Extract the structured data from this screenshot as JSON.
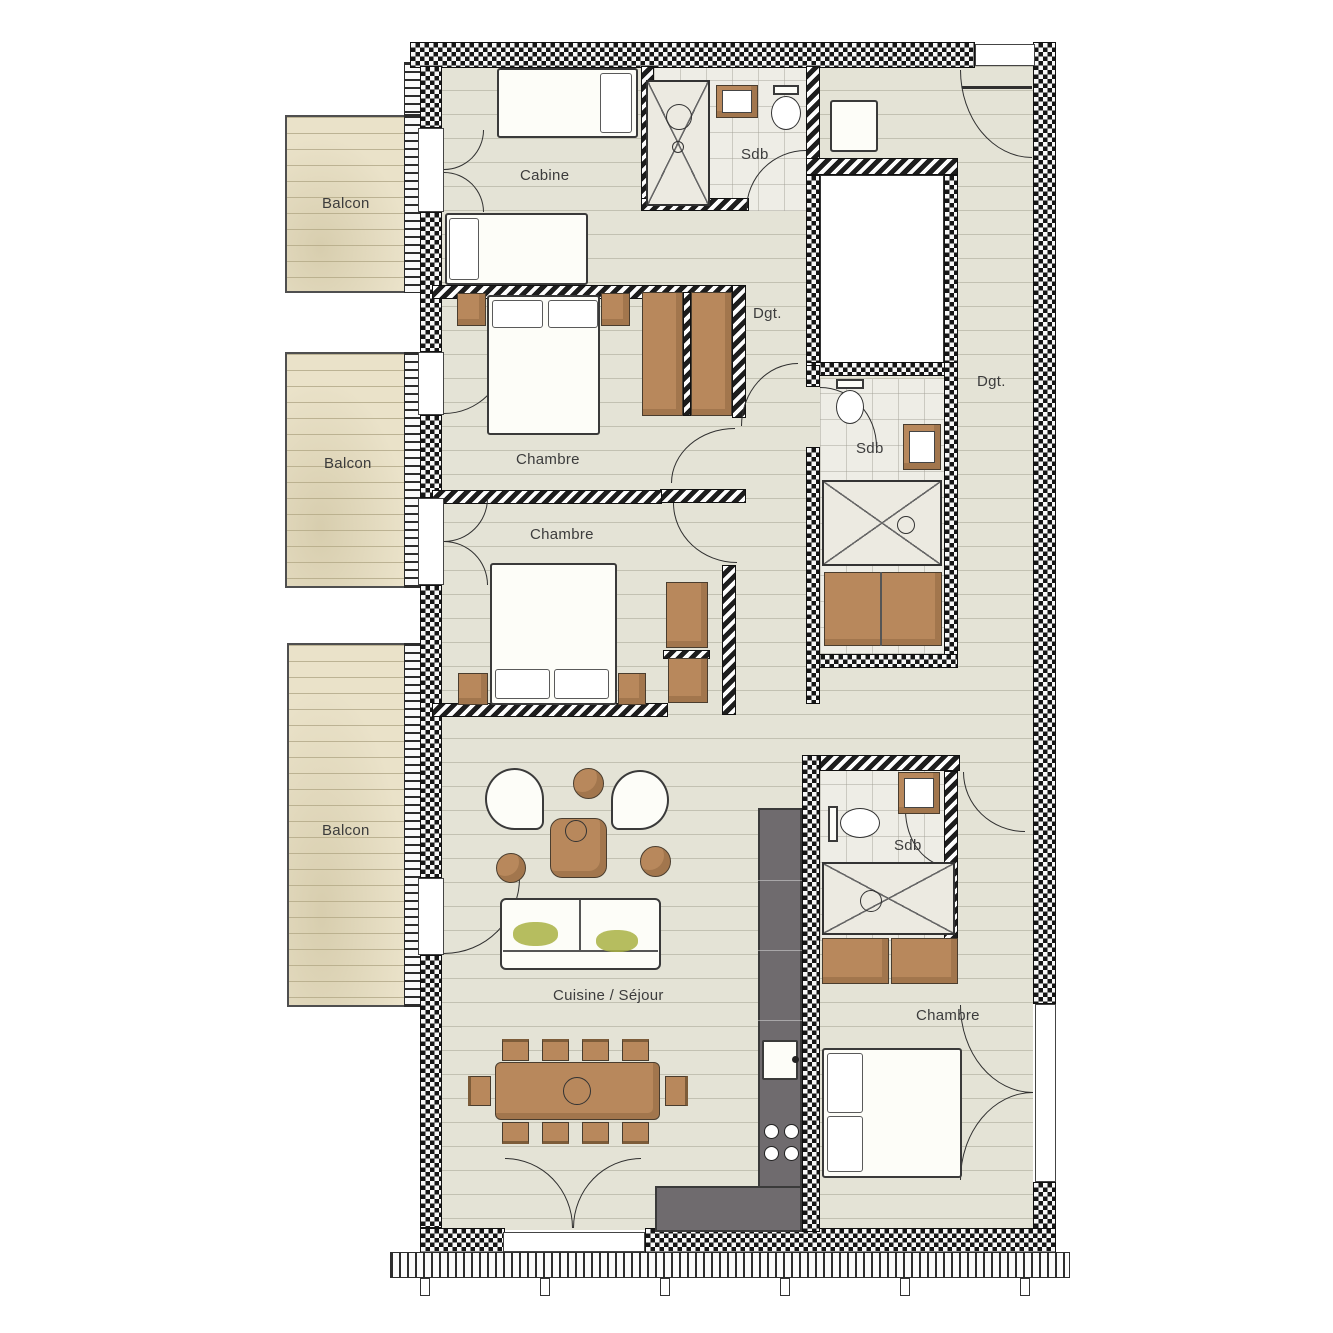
{
  "plan": {
    "rooms": {
      "balcon1": "Balcon",
      "balcon2": "Balcon",
      "balcon3": "Balcon",
      "cabine": "Cabine",
      "sdb_top": "Sdb",
      "sdb_middle": "Sdb",
      "sdb_bottom": "Sdb",
      "dgt_top": "Dgt.",
      "dgt_right": "Dgt.",
      "chambre1": "Chambre",
      "chambre2": "Chambre",
      "chambre3": "Chambre",
      "cuisine_sejour": "Cuisine / Séjour"
    },
    "colors": {
      "wall": "#1a1a1a",
      "floor": "#e4e3d6",
      "balcony_floor": "#eae2c9",
      "bath_floor": "#eeede6",
      "wood_furniture": "#b8885c",
      "kitchen_counter": "#6f6b6e",
      "accent_green": "#a9b244",
      "label_text": "#3c3c3c"
    }
  }
}
